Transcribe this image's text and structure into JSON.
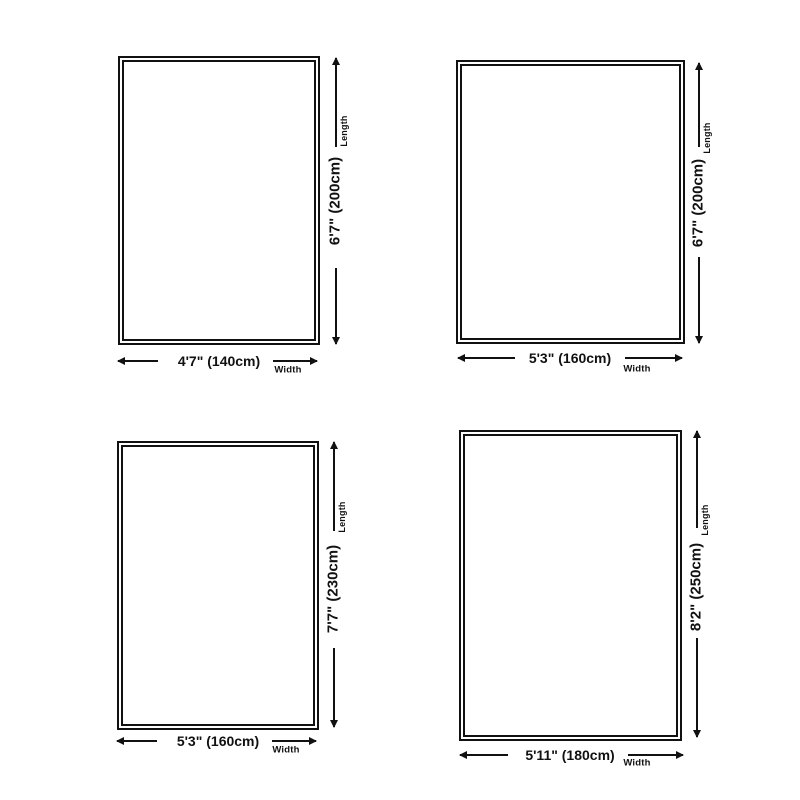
{
  "page": {
    "background": "#ffffff",
    "line_color": "#111111",
    "description": "Rug size chart with four rectangular size diagrams"
  },
  "labels": {
    "length": "Length",
    "width": "Width"
  },
  "sizes": [
    {
      "position": "top-left",
      "width_label": "4'7\" (140cm)",
      "length_label": "6'7\" (200cm)",
      "width_ft": "4'7\"",
      "length_ft": "6'7\"",
      "width_cm": 140,
      "length_cm": 200
    },
    {
      "position": "top-right",
      "width_label": "5'3\" (160cm)",
      "length_label": "6'7\" (200cm)",
      "width_ft": "5'3\"",
      "length_ft": "6'7\"",
      "width_cm": 160,
      "length_cm": 200
    },
    {
      "position": "bottom-left",
      "width_label": "5'3\" (160cm)",
      "length_label": "7'7\" (230cm)",
      "width_ft": "5'3\"",
      "length_ft": "7'7\"",
      "width_cm": 160,
      "length_cm": 230
    },
    {
      "position": "bottom-right",
      "width_label": "5'11\" (180cm)",
      "length_label": "8'2\" (250cm)",
      "width_ft": "5'11\"",
      "length_ft": "8'2\"",
      "width_cm": 180,
      "length_cm": 250
    }
  ]
}
